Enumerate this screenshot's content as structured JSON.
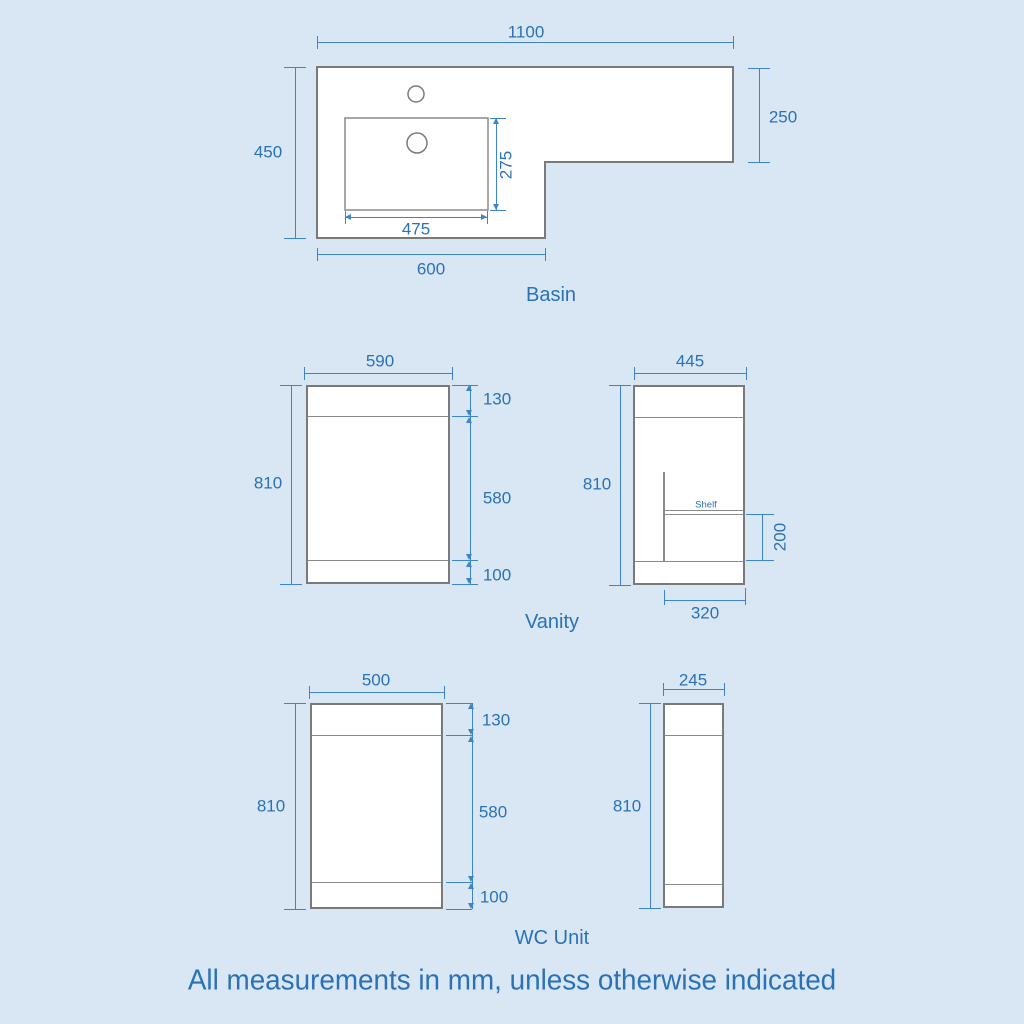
{
  "colors": {
    "background": "#d9e7f5",
    "line_blue": "#3d85c8",
    "text_blue": "#2a72b6",
    "outline_gray": "#7a7a7a",
    "inner_gray": "#8a8a8a"
  },
  "footnote": "All measurements in mm, unless otherwise indicated",
  "basin": {
    "label": "Basin",
    "dims": {
      "overall_width": "1100",
      "left_height": "450",
      "right_height": "250",
      "bowl_depth": "275",
      "bowl_width": "475",
      "left_width": "600"
    }
  },
  "vanity": {
    "label": "Vanity",
    "front": {
      "width": "590",
      "height": "810",
      "top_section": "130",
      "middle_section": "580",
      "bottom_section": "100"
    },
    "side": {
      "width": "445",
      "height": "810",
      "shelf_label": "Shelf",
      "shelf_height": "200",
      "shelf_depth": "320"
    }
  },
  "wc": {
    "label": "WC Unit",
    "front": {
      "width": "500",
      "height": "810",
      "top_section": "130",
      "middle_section": "580",
      "bottom_section": "100"
    },
    "side": {
      "width": "245",
      "height": "810"
    }
  }
}
